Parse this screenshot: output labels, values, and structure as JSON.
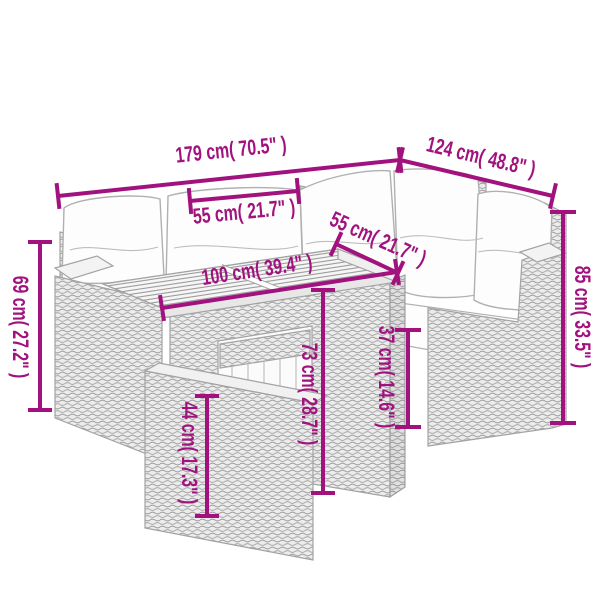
{
  "diagram": {
    "description": "Line drawing of an L-shaped poly-rattan garden lounge set (two sofa sections with white cushions, slatted-top table, ottoman) annotated with magenta dimension lines",
    "accent_color": "#a1127e",
    "dimensions": [
      {
        "id": "sofa-length-left",
        "label": "179 cm( 70.5\" )"
      },
      {
        "id": "sofa-length-right",
        "label": "124 cm( 48.8\" )"
      },
      {
        "id": "cushion-width",
        "label": "55 cm( 21.7\" )"
      },
      {
        "id": "table-depth",
        "label": "55 cm( 21.7\" )"
      },
      {
        "id": "table-length",
        "label": "100 cm( 39.4\" )"
      },
      {
        "id": "sofa-height-left",
        "label": "69 cm( 27.2\" )"
      },
      {
        "id": "sofa-height-right",
        "label": "85 cm( 33.5\" )"
      },
      {
        "id": "table-height",
        "label": "73 cm( 28.7\" )"
      },
      {
        "id": "seat-height",
        "label": "37 cm( 14.6\" )"
      },
      {
        "id": "ottoman-height",
        "label": "44 cm( 17.3\" )"
      }
    ]
  }
}
